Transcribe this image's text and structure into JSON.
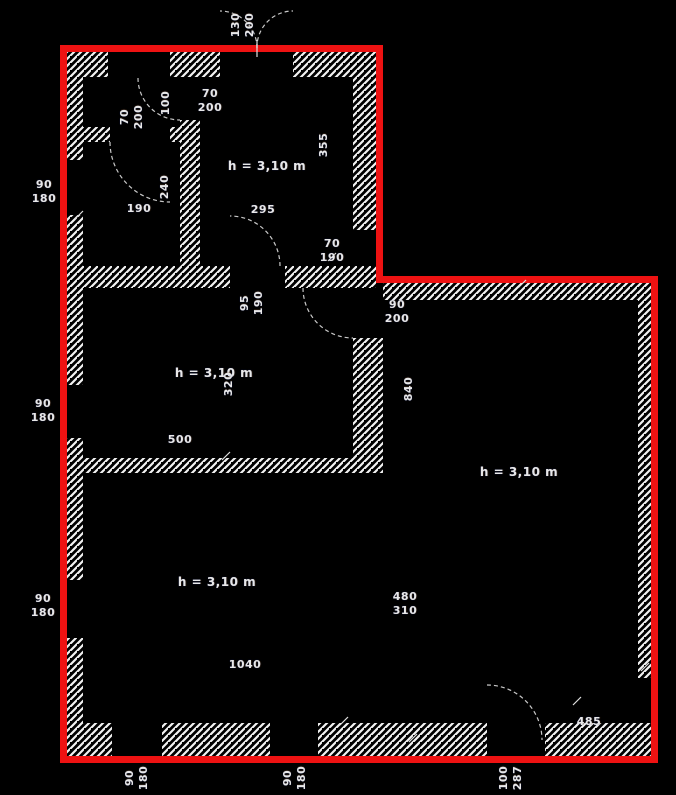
{
  "drawing": {
    "type": "architectural floor plan",
    "room_height_note": "h = 3,10 m"
  },
  "colors": {
    "background": "#000000",
    "outline": "#ee1212",
    "wall_hatch": "#f2f2f2",
    "arc": "#c8c8c8",
    "text": "#e8e8e8"
  },
  "labels": {
    "top_door": {
      "lines": [
        "130",
        "200"
      ]
    },
    "door_70_200_a": {
      "lines": [
        "70",
        "200"
      ]
    },
    "door_70_200_b": {
      "lines": [
        "70",
        "200"
      ]
    },
    "dim_100": {
      "lines": [
        "100"
      ]
    },
    "dim_240": {
      "lines": [
        "240"
      ]
    },
    "dim_190": {
      "lines": [
        "190"
      ]
    },
    "room1_height": {
      "lines": [
        "h = 3,10 m"
      ]
    },
    "dim_355": {
      "lines": [
        "355"
      ]
    },
    "dim_295": {
      "lines": [
        "295"
      ]
    },
    "window_70_190": {
      "lines": [
        "70",
        "190"
      ]
    },
    "window_left_1": {
      "lines": [
        "90",
        "180"
      ]
    },
    "window_left_2": {
      "lines": [
        "90",
        "180"
      ]
    },
    "window_left_3": {
      "lines": [
        "90",
        "180"
      ]
    },
    "door_95_190": {
      "lines": [
        "95",
        "190"
      ]
    },
    "door_90_200": {
      "lines": [
        "90",
        "200"
      ]
    },
    "room2_height": {
      "lines": [
        "h = 3,10 m"
      ]
    },
    "dim_320": {
      "lines": [
        "320"
      ]
    },
    "dim_500": {
      "lines": [
        "500"
      ]
    },
    "dim_840": {
      "lines": [
        "840"
      ]
    },
    "room3_height": {
      "lines": [
        "h = 3,10 m"
      ]
    },
    "room4_height": {
      "lines": [
        "h = 3,10 m"
      ]
    },
    "dim_480_310": {
      "lines": [
        "480",
        "310"
      ]
    },
    "dim_1040": {
      "lines": [
        "1040"
      ]
    },
    "dim_485": {
      "lines": [
        "485"
      ]
    },
    "window_bottom_1": {
      "lines": [
        "90",
        "180"
      ]
    },
    "window_bottom_2": {
      "lines": [
        "90",
        "180"
      ]
    },
    "door_bottom": {
      "lines": [
        "100",
        "287"
      ]
    }
  }
}
